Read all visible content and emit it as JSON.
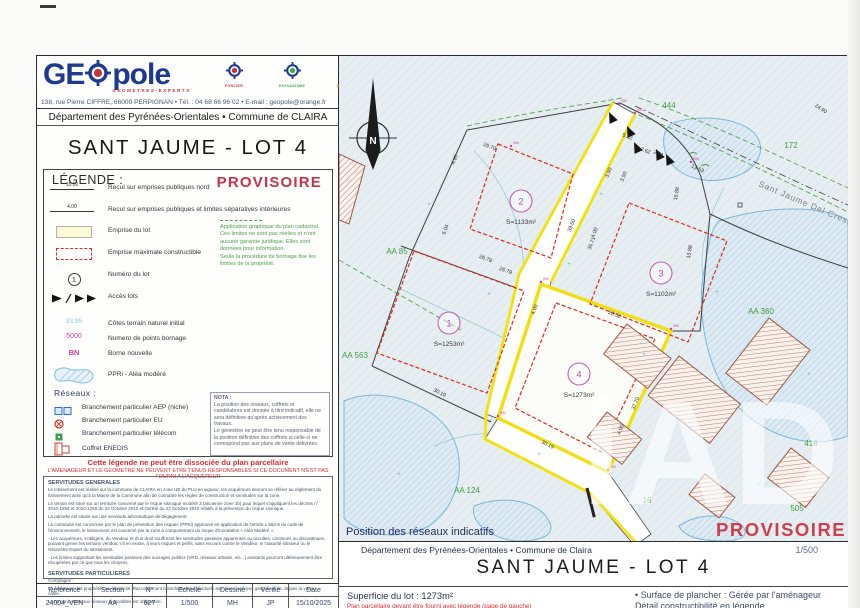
{
  "header": {
    "logo_ge": "GE",
    "logo_pole": "pole",
    "logo_sub": "GEOMETRES-EXPERTS",
    "badges": [
      {
        "label": "FONCIER",
        "color": "#c4343c"
      },
      {
        "label": "PAYSAGISME",
        "color": "#3fae49"
      },
      {
        "label": "MAITRISE OE",
        "color": "#e0a23e"
      }
    ],
    "address": "138, rue Pierre CIFFRE, 66000 PERPIGNAN  •  Tél. : 04 68 66 96 02  •  E-mail : geopole@orange.fr"
  },
  "left": {
    "dept": "Département des Pyrénées-Orientales • Commune de CLAIRA",
    "title": "SANT JAUME - LOT 4",
    "legend": {
      "heading": "LÉGENDE :",
      "provisoire": "PROVISOIRE",
      "items": [
        {
          "sym": "15.00",
          "label": "Recul sur emprises publiques nord"
        },
        {
          "sym": "4.00",
          "label": "Recul sur emprises publiques et limites séparatives intérieures"
        },
        {
          "label": "Emprise du lot"
        },
        {
          "label": "Emprise maximale constructible"
        },
        {
          "sym": "1",
          "label": "Numéro du lot"
        },
        {
          "label": "Accès lots"
        },
        {
          "sym": "33.95",
          "label": "Côtes terrain naturel initial"
        },
        {
          "sym": "5000",
          "label": "Numero de points bornage"
        },
        {
          "sym": "BN",
          "label": "Borne nouvelle"
        },
        {
          "label": "PPRi - Aléa modéré"
        }
      ],
      "cadastral_note": [
        "Application graphique du plan cadastral.",
        "Ces limites ne sont pas réelles et n'ont",
        "aucune garantie juridique. Elles sont",
        "données pour information.",
        "Seule la procédure de bornage fixe les",
        "limites de la propriété."
      ],
      "reseaux_heading": "Réseaux :",
      "reseaux_items": [
        {
          "label": "Branchement particulier AEP (niche)"
        },
        {
          "label": "Branchement particulier EU"
        },
        {
          "label": "Branchement particulier télécom"
        },
        {
          "label": "Coffret ENEDIS"
        }
      ],
      "nota_title": "NOTA :",
      "nota_lines": [
        "La position des réseaux, coffrets et",
        "candélabres est donnée à titre indicatif, elle ne",
        "sera définitive qu'après achèvement des",
        "travaux.",
        "Le géomètre ne peut être tenu responsable de",
        "la position définitive des coffrets si celle-ci ne",
        "correspond pas aux plans de vente délivrées."
      ],
      "warning1": "Cette légende ne peut être dissociée du plan parcellaire",
      "warning2": "L'AMENAGEUR ET LE GEOMETRE NE PEUVENT ETRE TENUS RESPONSABLES SI CE DOCUMENT N'EST PAS FOURNI A L'ACQUEREUR"
    },
    "servitudes": {
      "gen_title": "SERVITUDES GENERALES",
      "gen_paragraphs": [
        "Le lotissement est réalisé sur la commune de CLAIRA en zone UE du PLU en vigueur, les acquéreurs devront se référer au règlement du lotissement ainsi qu'à la Mairie de la Commune afin de connaître les règles de construction et servitudes sur la zone.",
        "Le terrain est situé sur un territoire concerné par le risque sismique modéré 3 (ancienne zone 1b) pour lequel s'appliquent les décrets n° 2010-1254 et 2010-1255 du 22 Octobre 2010 et l'arrêté du 22 Octobre 2010 relatifs à la prévention du risque sismique.",
        "La parcelle est située sur une servitude aéronautique de dégagement.",
        "La commune est concernée par le plan de prévention des risques (PPRi) approuvé en application de l'article L 562-6 du code de l'environnement, le lotissement est concerné par la zone à comportement du risque d'inondation « Aléa Modéré ».",
        "- Les acquéreurs, s'obligent, du Vendeur et d'un droit souffriront les servitudes passives apparentes ou occultes, continues ou discontinues, pouvant grever les terrains vendus, s'il en existe, à leurs risques et périls, sans recours contre le Vendeur, ni l'autorité lotisseur ou le Géomètre Expert du lotissement.",
        "- Les limites supportant les servitudes passives des ouvrages publics (VRD, réseaux urbains, etc...) existants pourront ultérieurement être récupérées par ce que tous les citoyens."
      ],
      "part_title": "SERVITUDES PARTICULIERES",
      "part_lines": [
        "Comptages :",
        "Le comptage des propriétés en électricité. Raccordement branchements individuels aux divers services gestionnaires, depuis la voirie, câble.",
        "Le raccordement aux réseaux disponibles est obligatoire."
      ]
    },
    "table": {
      "headers": [
        "Référence",
        "Section",
        "N°",
        "Echelle",
        "Dessiné",
        "Vérifié",
        "Date"
      ],
      "row": [
        "24004_VEN",
        "AA",
        "627",
        "1/500",
        "MH",
        "JP",
        "15/10/2025"
      ]
    }
  },
  "map": {
    "north_label": "N",
    "street": "Sant Jaume Del Crest",
    "pos_reseaux": "Position des réseaux indicatifs",
    "watermark": "iAD",
    "provisoire": "PROVISOIRE",
    "lots": [
      {
        "n": "1",
        "area": "S=1253m²",
        "cx": 110,
        "cy": 267
      },
      {
        "n": "2",
        "area": "S=1133m²",
        "cx": 182,
        "cy": 145
      },
      {
        "n": "3",
        "area": "S=1102m²",
        "cx": 322,
        "cy": 217
      },
      {
        "n": "4",
        "area": "S=1273m²",
        "cx": 240,
        "cy": 318
      }
    ],
    "parcel_labels": [
      {
        "t": "444",
        "x": 330,
        "y": 52
      },
      {
        "t": "172",
        "x": 452,
        "y": 92
      },
      {
        "t": "AA 85",
        "x": 58,
        "y": 198
      },
      {
        "t": "AA 563",
        "x": 16,
        "y": 302
      },
      {
        "t": "AA 124",
        "x": 128,
        "y": 437
      },
      {
        "t": "AA 360",
        "x": 422,
        "y": 258
      },
      {
        "t": "418",
        "x": 472,
        "y": 390
      },
      {
        "t": "16",
        "x": 308,
        "y": 447
      },
      {
        "t": "505",
        "x": 458,
        "y": 455
      }
    ],
    "dimensions": [
      {
        "t": "39.60",
        "x": 234,
        "y": 170,
        "r": -69
      },
      {
        "t": "35.71",
        "x": 254,
        "y": 188,
        "r": -69
      },
      {
        "t": "26.78",
        "x": 146,
        "y": 204,
        "r": 21
      },
      {
        "t": "26.79",
        "x": 166,
        "y": 216,
        "r": 21
      },
      {
        "t": "26.52",
        "x": 275,
        "y": 260,
        "r": 21
      },
      {
        "t": "37.70",
        "x": 298,
        "y": 348,
        "r": -69
      },
      {
        "t": "30.19",
        "x": 208,
        "y": 390,
        "r": 27
      },
      {
        "t": "30.19",
        "x": 100,
        "y": 338,
        "r": 27
      },
      {
        "t": "13.53",
        "x": 358,
        "y": 114,
        "r": 24
      },
      {
        "t": "15.88",
        "x": 339,
        "y": 138,
        "r": -80
      },
      {
        "t": "24.90",
        "x": 481,
        "y": 54,
        "r": 33
      },
      {
        "t": "5.52",
        "x": 288,
        "y": 82,
        "r": 21
      },
      {
        "t": "2.62",
        "x": 306,
        "y": 96,
        "r": 21
      },
      {
        "t": "2.61",
        "x": 319,
        "y": 99,
        "r": 21
      },
      {
        "t": "3.50",
        "x": 271,
        "y": 117,
        "r": -69
      },
      {
        "t": "3.50",
        "x": 286,
        "y": 121,
        "r": -69
      },
      {
        "t": "4.00",
        "x": 117,
        "y": 104,
        "r": -69
      },
      {
        "t": "4.00",
        "x": 257,
        "y": 177,
        "r": -69
      },
      {
        "t": "4.00",
        "x": 197,
        "y": 254,
        "r": -69
      },
      {
        "t": "4.00",
        "x": 283,
        "y": 374,
        "r": -69
      },
      {
        "t": "6.04",
        "x": 108,
        "y": 174,
        "r": -69
      },
      {
        "t": "26.70",
        "x": 150,
        "y": 92,
        "r": 21
      },
      {
        "t": "15.88",
        "x": 352,
        "y": 196,
        "r": -80
      }
    ],
    "bn_marks": [
      {
        "t": "BN",
        "x": 280,
        "y": 48
      },
      {
        "t": "BN",
        "x": 296,
        "y": 57
      },
      {
        "t": "BN",
        "x": 202,
        "y": 226
      },
      {
        "t": "BN",
        "x": 332,
        "y": 273
      },
      {
        "t": "BN",
        "x": 159,
        "y": 360
      },
      {
        "t": "BN",
        "x": 269,
        "y": 414
      },
      {
        "t": "BN",
        "x": 352,
        "y": 106
      },
      {
        "t": "BN",
        "x": 172,
        "y": 90
      }
    ],
    "spot_marks": [
      {
        "x": 150,
        "y": 240
      },
      {
        "x": 230,
        "y": 210
      },
      {
        "x": 305,
        "y": 300
      },
      {
        "x": 200,
        "y": 400
      },
      {
        "x": 420,
        "y": 430
      },
      {
        "x": 90,
        "y": 150
      },
      {
        "x": 262,
        "y": 140
      },
      {
        "x": 378,
        "y": 238
      },
      {
        "x": 60,
        "y": 420
      },
      {
        "x": 470,
        "y": 320
      }
    ],
    "footer": {
      "dept": "Département des Pyrénées-Orientales • Commune de Claira",
      "scale": "1/500",
      "title": "SANT JAUME - LOT 4",
      "area_label": "Superficie du lot : 1273m²",
      "red_note": "Plan parcellaire devant être fourni avec légende (page de gauche)",
      "right_line1": "• Surface de plancher : Gérée par l'aménageur",
      "right_line2": "Détail constructibilité en légende"
    }
  }
}
